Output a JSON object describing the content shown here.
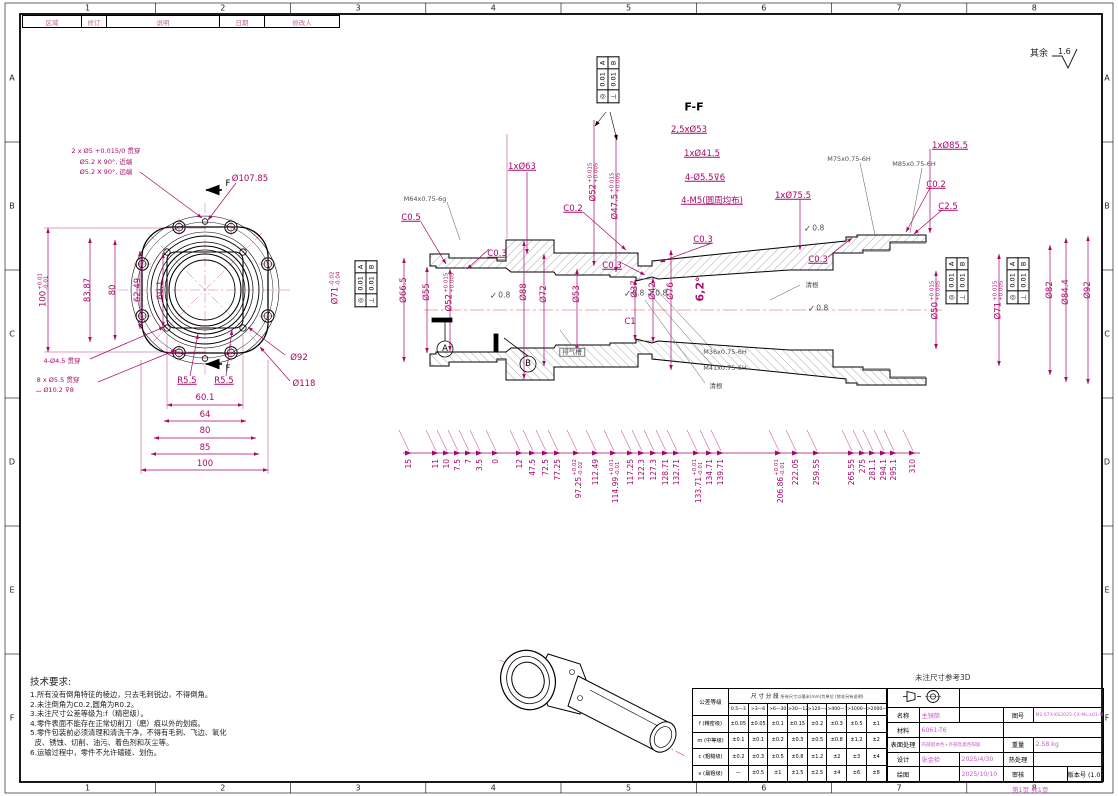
{
  "frame": {
    "cols": [
      "1",
      "2",
      "3",
      "4",
      "5",
      "6",
      "7",
      "8"
    ],
    "rows": [
      "A",
      "B",
      "C",
      "D",
      "E",
      "F"
    ]
  },
  "revision": {
    "headers": [
      {
        "t": "区域",
        "w": 58
      },
      {
        "t": "修订",
        "w": 24
      },
      {
        "t": "说明",
        "w": 112
      },
      {
        "t": "日期",
        "w": 44
      },
      {
        "t": "修改人",
        "w": 74
      }
    ]
  },
  "notes": {
    "surface_prefix": "其余",
    "surface_value": "1.6",
    "ref_3d": "未注尺寸参考3D",
    "page": "第1页 共1页"
  },
  "tech": {
    "title": "技术要求:",
    "lines": [
      "1.所有没有倒角特征的棱边，只去毛刺锐边，不得倒角。",
      "2.未注倒角为C0.2,圆角为R0.2。",
      "3.未注尺寸公差等级为:f（精密级）。",
      "4.零件表面不能存在正常切削刀（磨）痕以外的划痕。",
      "5.零件包装前必须清理和清洗干净，不得有毛刺、飞边、氧化",
      "  皮、锈蚀、切削、油污、着色剂和灰尘等。",
      "6.运输过程中，零件不允许磕碰、划伤。"
    ]
  },
  "fcf": {
    "rows": [
      [
        "◎",
        "0.01",
        "A"
      ],
      [
        "⊥",
        "0.01",
        "B"
      ]
    ]
  },
  "labels": [
    {
      "n": "dim-100-v",
      "t": "100",
      "sup": "+0.01",
      "sub": "-0.01",
      "x": 44,
      "y": 290,
      "rot": 1
    },
    {
      "n": "dim-83-87",
      "t": "83.87",
      "x": 88,
      "y": 290,
      "rot": 1
    },
    {
      "n": "dim-80-v",
      "t": "80",
      "x": 113,
      "y": 290,
      "rot": 1
    },
    {
      "n": "dim-62-49",
      "t": "62.49",
      "x": 138,
      "y": 290,
      "rot": 1
    },
    {
      "n": "dim-60-1-v",
      "t": "60.1",
      "x": 161,
      "y": 290,
      "rot": 1
    },
    {
      "n": "dim-phi107-85",
      "t": "Ø107.85",
      "x": 250,
      "y": 179
    },
    {
      "n": "dim-phi92-front",
      "t": "Ø92",
      "x": 299,
      "y": 358
    },
    {
      "n": "dim-phi118",
      "t": "Ø118",
      "x": 304,
      "y": 384
    },
    {
      "n": "dim-r5-5-left",
      "t": "R5.5",
      "x": 187,
      "y": 381,
      "ul": 1
    },
    {
      "n": "dim-r5-5-right",
      "t": "R5.5",
      "x": 224,
      "y": 381,
      "ul": 1
    },
    {
      "n": "note-4xphi4-5",
      "t": "4-Ø4.5 贯穿",
      "x": 62,
      "y": 361,
      "cls": "sm"
    },
    {
      "n": "note-8xphi5-5",
      "t": "8 x Ø5.5 贯穿",
      "x": 58,
      "y": 380,
      "cls": "sm"
    },
    {
      "n": "note-cbore",
      "t": "⌴ Ø10.2 ⊽8",
      "x": 55,
      "y": 390,
      "cls": "sm"
    },
    {
      "n": "note-2xphi5",
      "t": "2 x Ø5 +0.015/0 贯穿",
      "x": 106,
      "y": 151,
      "cls": "sm"
    },
    {
      "n": "note-csk-near",
      "t": "Ø5.2 X 90°, 近端",
      "x": 106,
      "y": 162,
      "cls": "sm"
    },
    {
      "n": "note-csk-far",
      "t": "Ø5.2 X 90°, 远端",
      "x": 106,
      "y": 172,
      "cls": "sm"
    },
    {
      "n": "section-f-top",
      "t": "F",
      "x": 228,
      "y": 184,
      "cls": "blk"
    },
    {
      "n": "section-f-bot",
      "t": "F",
      "x": 228,
      "y": 369,
      "cls": "blk"
    },
    {
      "n": "dim-60-1-h",
      "t": "60.1",
      "x": 205,
      "y": 398
    },
    {
      "n": "dim-64",
      "t": "64",
      "x": 205,
      "y": 415
    },
    {
      "n": "dim-80-h",
      "t": "80",
      "x": 205,
      "y": 431
    },
    {
      "n": "dim-85",
      "t": "85",
      "x": 205,
      "y": 448
    },
    {
      "n": "dim-100-h",
      "t": "100",
      "x": 205,
      "y": 464
    },
    {
      "n": "label-ff",
      "t": "F-F",
      "x": 694,
      "y": 107,
      "cls": "blk bigb"
    },
    {
      "n": "dim-1x63",
      "t": "1xØ63",
      "x": 522,
      "y": 167,
      "ul": 1
    },
    {
      "n": "dim-2-5x53",
      "t": "2,5xØ53",
      "x": 689,
      "y": 130,
      "ul": 1
    },
    {
      "n": "dim-1x41-5",
      "t": "1xØ41.5",
      "x": 702,
      "y": 154,
      "ul": 1
    },
    {
      "n": "dim-4x5-5",
      "t": "4-Ø5.5⊽6",
      "x": 705,
      "y": 178,
      "ul": 1
    },
    {
      "n": "dim-4m5",
      "t": "4-M5(圆周均布)",
      "x": 712,
      "y": 201,
      "ul": 1
    },
    {
      "n": "dim-phi52-top",
      "t": "Ø52",
      "sup": "+0.015",
      "sub": "+0.005",
      "x": 594,
      "y": 182,
      "rot": 1
    },
    {
      "n": "dim-phi47-5",
      "t": "Ø47.5",
      "sup": "+0.015",
      "sub": "+0.005",
      "x": 616,
      "y": 196,
      "rot": 1
    },
    {
      "n": "thread-m75",
      "t": "M75x0.75-6H",
      "x": 849,
      "y": 159,
      "cls": "gray sm"
    },
    {
      "n": "thread-m85",
      "t": "M85x0.75-6H",
      "x": 914,
      "y": 164,
      "cls": "gray sm"
    },
    {
      "n": "dim-1x85-5",
      "t": "1xØ85.5",
      "x": 950,
      "y": 146,
      "ul": 1
    },
    {
      "n": "dim-1x75-5",
      "t": "1xØ75.5",
      "x": 793,
      "y": 196,
      "ul": 1
    },
    {
      "n": "dim-c0-2-r",
      "t": "C0.2",
      "x": 936,
      "y": 185,
      "ul": 1
    },
    {
      "n": "dim-c2-5",
      "t": "C2.5",
      "x": 948,
      "y": 207,
      "ul": 1
    },
    {
      "n": "thread-m64",
      "t": "M64x0.75-6g",
      "x": 425,
      "y": 199,
      "cls": "gray sm"
    },
    {
      "n": "dim-c0-5",
      "t": "C0.5",
      "x": 411,
      "y": 218,
      "ul": 1
    },
    {
      "n": "dim-c0-2-m",
      "t": "C0.2",
      "x": 573,
      "y": 209,
      "ul": 1
    },
    {
      "n": "dim-c0-3-a",
      "t": "C0.3",
      "x": 497,
      "y": 254,
      "ul": 1
    },
    {
      "n": "dim-c0-3-b",
      "t": "C0.3",
      "x": 612,
      "y": 266,
      "ul": 1
    },
    {
      "n": "dim-c0-3-c",
      "t": "C0.3",
      "x": 703,
      "y": 240,
      "ul": 1
    },
    {
      "n": "dim-c0-3-d",
      "t": "C0.3",
      "x": 818,
      "y": 260,
      "ul": 1
    },
    {
      "n": "dim-c1",
      "t": "C1",
      "x": 630,
      "y": 322
    },
    {
      "n": "note-vent-groove",
      "t": "排气槽",
      "x": 572,
      "y": 352,
      "cls": "gray sm box"
    },
    {
      "n": "note-qinggen-1",
      "t": "清根",
      "x": 812,
      "y": 285,
      "cls": "gray sm"
    },
    {
      "n": "thread-m36",
      "t": "M36x0.75-6H",
      "x": 725,
      "y": 352,
      "cls": "gray sm"
    },
    {
      "n": "thread-m41",
      "t": "M41x0.75-6H",
      "x": 725,
      "y": 368,
      "cls": "gray sm"
    },
    {
      "n": "note-qinggen-2",
      "t": "清根",
      "x": 716,
      "y": 386,
      "cls": "gray sm"
    },
    {
      "n": "dim-phi71-left",
      "t": "Ø71",
      "sup": "-0.02",
      "sub": "-0.04",
      "x": 336,
      "y": 288,
      "rot": 1
    },
    {
      "n": "dim-phi66-5",
      "t": "Ø66.5",
      "x": 404,
      "y": 290,
      "rot": 1
    },
    {
      "n": "dim-phi55",
      "t": "Ø55",
      "x": 427,
      "y": 292,
      "rot": 1
    },
    {
      "n": "dim-phi52-left",
      "t": "Ø52",
      "sup": "+0.015",
      "sub": "+0.005",
      "x": 450,
      "y": 292,
      "rot": 1
    },
    {
      "n": "dim-phi88",
      "t": "Ø88",
      "x": 524,
      "y": 292,
      "rot": 1
    },
    {
      "n": "dim-phi72",
      "t": "Ø72",
      "x": 544,
      "y": 294,
      "rot": 1
    },
    {
      "n": "dim-phi53",
      "t": "Ø53",
      "x": 577,
      "y": 294,
      "rot": 1
    },
    {
      "n": "dim-phi37",
      "t": "Ø37",
      "x": 635,
      "y": 289,
      "rot": 1
    },
    {
      "n": "dim-phi42",
      "t": "Ø42",
      "x": 653,
      "y": 291,
      "rot": 1
    },
    {
      "n": "dim-phi76",
      "t": "Ø76",
      "x": 671,
      "y": 291,
      "rot": 1
    },
    {
      "n": "dim-angle-6-2",
      "t": "6,2°",
      "x": 700,
      "y": 289,
      "rot": 1,
      "cls": "bigb"
    },
    {
      "n": "dim-phi50-right",
      "t": "Ø50",
      "sup": "+0.015",
      "sub": "+0.005",
      "x": 936,
      "y": 300,
      "rot": 1
    },
    {
      "n": "dim-phi71-right",
      "t": "Ø71",
      "sup": "+0.015",
      "sub": "+0.005",
      "x": 999,
      "y": 300,
      "rot": 1
    },
    {
      "n": "dim-phi82",
      "t": "Ø82",
      "x": 1050,
      "y": 290,
      "rot": 1
    },
    {
      "n": "dim-phi84-4",
      "t": "Ø84.4",
      "x": 1066,
      "y": 292,
      "rot": 1
    },
    {
      "n": "dim-phi92-right",
      "t": "Ø92",
      "x": 1088,
      "y": 290,
      "rot": 1
    },
    {
      "n": "datum-a-label",
      "t": "A",
      "x": 445,
      "y": 349,
      "cls": "blk"
    },
    {
      "n": "datum-b-label",
      "t": "B",
      "x": 528,
      "y": 364,
      "cls": "blk"
    },
    {
      "n": "rough-1",
      "t": "0.8",
      "x": 500,
      "y": 295,
      "cls": "rough"
    },
    {
      "n": "rough-2",
      "t": "0.8",
      "x": 634,
      "y": 293,
      "cls": "rough"
    },
    {
      "n": "rough-3",
      "t": "0.8",
      "x": 657,
      "y": 293,
      "cls": "rough"
    },
    {
      "n": "rough-4",
      "t": "0.8",
      "x": 814,
      "y": 228,
      "cls": "rough"
    },
    {
      "n": "rough-5",
      "t": "0.8",
      "x": 818,
      "y": 308,
      "cls": "rough"
    }
  ],
  "bottom_chain": [
    {
      "t": "15",
      "x": 409
    },
    {
      "t": "11",
      "x": 436
    },
    {
      "t": "10",
      "x": 447
    },
    {
      "t": "7.5",
      "x": 458
    },
    {
      "t": "7",
      "x": 469
    },
    {
      "t": "3.5",
      "x": 480
    },
    {
      "t": "0",
      "x": 496
    },
    {
      "t": "12",
      "x": 520
    },
    {
      "t": "47.5",
      "x": 533
    },
    {
      "t": "72.5",
      "x": 546
    },
    {
      "t": "77.25",
      "x": 558
    },
    {
      "t": "97.25",
      "sup": "+0.02",
      "sub": "-0.02",
      "x": 577
    },
    {
      "t": "112.49",
      "x": 596
    },
    {
      "t": "114.99",
      "sup": "+0.01",
      "sub": "-0.01",
      "x": 614
    },
    {
      "t": "117.25",
      "x": 631
    },
    {
      "t": "122.3",
      "x": 642
    },
    {
      "t": "127.3",
      "x": 654
    },
    {
      "t": "128.71",
      "x": 666
    },
    {
      "t": "132.71",
      "x": 677
    },
    {
      "t": "133.71",
      "sup": "+0.01",
      "sub": "-0.01",
      "x": 697
    },
    {
      "t": "134.71",
      "x": 710
    },
    {
      "t": "139.71",
      "x": 721
    },
    {
      "t": "206.86",
      "sup": "+0.01",
      "sub": "-0.01",
      "x": 779
    },
    {
      "t": "222.05",
      "x": 796
    },
    {
      "t": "259.55",
      "x": 817
    },
    {
      "t": "265.55",
      "x": 852
    },
    {
      "t": "275",
      "x": 863
    },
    {
      "t": "281.1",
      "x": 873
    },
    {
      "t": "294.1",
      "x": 884
    },
    {
      "t": "295.1",
      "x": 894
    },
    {
      "t": "310",
      "x": 913
    }
  ],
  "title_block": {
    "tol_title": "公差等级",
    "seg_title": "尺 寸 分 段",
    "seg_note": "所有尺寸以毫米(mm)为单位 (除非另有说明)",
    "col_headers": [
      "0.5—3",
      ">3—6",
      ">6—30",
      ">30—120",
      ">120—400",
      ">400—1000",
      ">1000—2000",
      ">2000—4000"
    ],
    "rows": [
      {
        "label": "f (精密级)",
        "values": [
          "±0.05",
          "±0.05",
          "±0.1",
          "±0.15",
          "±0.2",
          "±0.3",
          "±0.5",
          "±1"
        ]
      },
      {
        "label": "m (中等级)",
        "values": [
          "±0.1",
          "±0.1",
          "±0.2",
          "±0.3",
          "±0.5",
          "±0.8",
          "±1.2",
          "±2"
        ]
      },
      {
        "label": "c (粗糙级)",
        "values": [
          "±0.2",
          "±0.3",
          "±0.5",
          "±0.8",
          "±1.2",
          "±2",
          "±3",
          "±4"
        ]
      },
      {
        "label": "v (最粗级)",
        "values": [
          "—",
          "±0.5",
          "±1",
          "±1.5",
          "±2.5",
          "±4",
          "±6",
          "±8"
        ]
      }
    ],
    "fields": {
      "name_label": "名称",
      "name": "主镜筒",
      "dwg_label": "图号",
      "dwg_no": "M2.67X-KS2025-CX-ML-L01-M11",
      "material_label": "材料",
      "material": "6061-T6",
      "finish_label": "表面处理",
      "finish": "内部铝本色+外部亮黑色阳极",
      "weight_label": "重量",
      "weight": "2.58 kg",
      "design_label": "设计",
      "designer": "张金检",
      "design_date": "2025/4/30",
      "heat_label": "热处理",
      "heat": "",
      "draw_label": "绘图",
      "draw_date": "2025/10/10",
      "check_label": "审核",
      "check": "",
      "version": "版本号 (1.0)"
    }
  }
}
